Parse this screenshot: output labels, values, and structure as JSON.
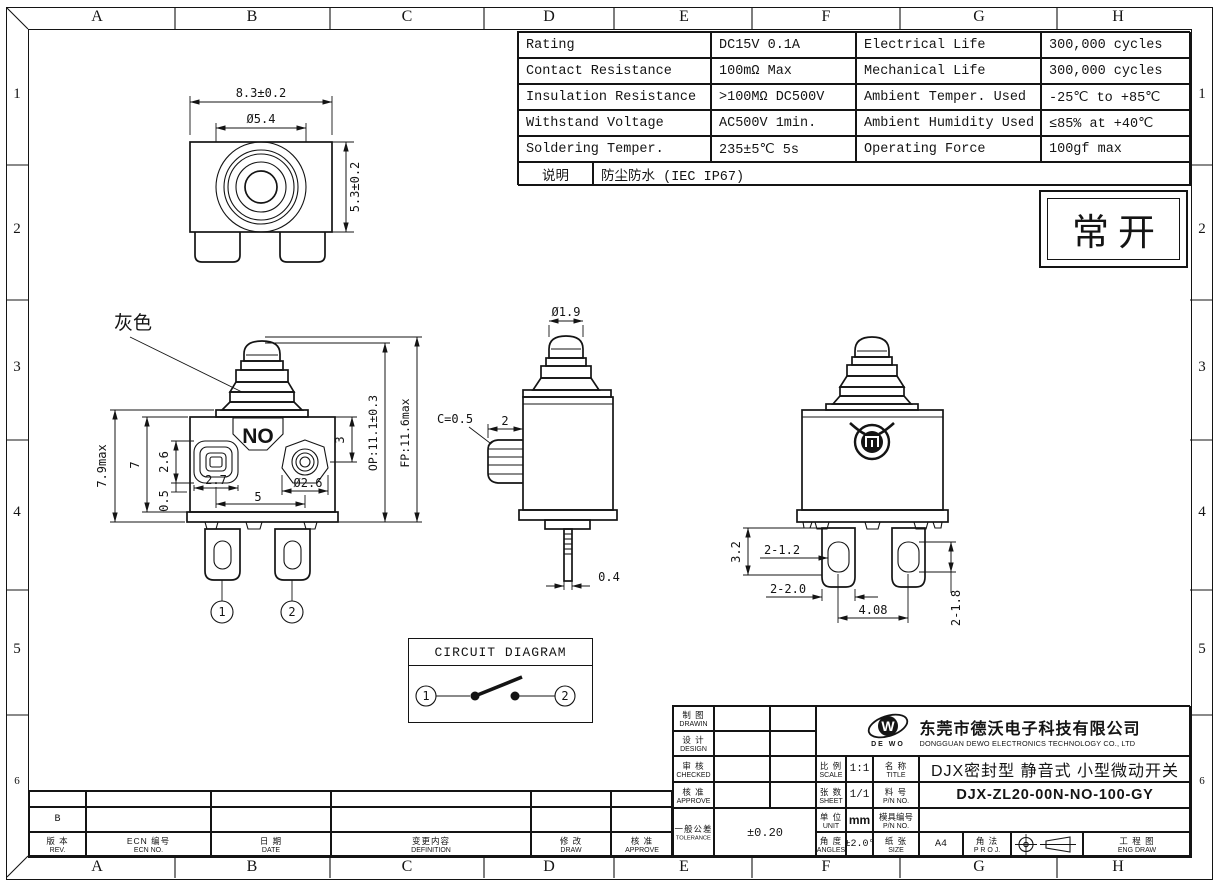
{
  "frame": {
    "cols": [
      "A",
      "B",
      "C",
      "D",
      "E",
      "F",
      "G",
      "H"
    ],
    "rows": [
      "1",
      "2",
      "3",
      "4",
      "5",
      "6"
    ]
  },
  "spec_table": {
    "rows": [
      {
        "p": "Rating",
        "pv": "DC15V 0.1A",
        "q": "Electrical Life",
        "qv": "300,000 cycles"
      },
      {
        "p": "Contact Resistance",
        "pv": "100mΩ Max",
        "q": "Mechanical Life",
        "qv": "300,000 cycles"
      },
      {
        "p": "Insulation Resistance",
        "pv": ">100MΩ DC500V",
        "q": "Ambient Temper. Used",
        "qv": "-25℃ to +85℃"
      },
      {
        "p": "Withstand Voltage",
        "pv": "AC500V  1min.",
        "q": "Ambient Humidity Used",
        "qv": "≤85% at +40℃"
      },
      {
        "p": "Soldering Temper.",
        "pv": "235±5℃ 5s",
        "q": "Operating Force",
        "qv": "100gf max"
      }
    ],
    "note_label": "说明",
    "note_value": "防尘防水 (IEC IP67)"
  },
  "state_box": {
    "text": "常开"
  },
  "views": {
    "top": {
      "dim_width": "8.3±0.2",
      "dim_circle": "Ø5.4",
      "dim_height": "5.3±0.2"
    },
    "front": {
      "gray_label": "灰色",
      "no_label": "NO",
      "dim_total_h": "7.9max",
      "dim_body_h": "7",
      "dim_term_sq": "2.6",
      "dim_base": "0.5",
      "dim_term_w": "2.7",
      "dim_pitch": "5",
      "dim_term_dia": "Ø2.6",
      "dim_depth": "3",
      "dim_op": "OP:11.1±0.3",
      "dim_fp": "FP:11.6max",
      "t1": "1",
      "t2": "2"
    },
    "side": {
      "dim_tip": "Ø1.9",
      "dim_chamfer": "C=0.5",
      "dim_boss": "2",
      "dim_pin": "0.4"
    },
    "rear": {
      "dim_h": "3.2",
      "dim_hole_w": "2-1.2",
      "dim_lug_w": "2-2.0",
      "dim_pitch": "4.08",
      "dim_hole_h": "2-1.8"
    }
  },
  "circuit": {
    "title": "CIRCUIT DIAGRAM",
    "t1": "1",
    "t2": "2"
  },
  "title_block": {
    "drawn_cn": "制 图",
    "drawn_en": "DRAWIN",
    "design_cn": "设 计",
    "design_en": "DESIGN",
    "checked_cn": "审 核",
    "checked_en": "CHECKED",
    "approve_cn": "核 准",
    "approve_en": "APPROVE",
    "tol_cn": "一般公差",
    "tol_en": "TOLERANCE",
    "tol_value": "±0.20",
    "scale_cn": "比 例",
    "scale_en": "SCALE",
    "scale_value": "1:1",
    "sheet_cn": "张 数",
    "sheet_en": "SHEET",
    "sheet_value": "1/1",
    "unit_cn": "单 位",
    "unit_en": "UNIT",
    "unit_value": "mm",
    "angles_cn": "角 度",
    "angles_en": "ANGLES",
    "angles_value": "±2.0°",
    "title_cn": "名 称",
    "title_en": "TITLE",
    "title_value": "DJX密封型 静音式 小型微动开关",
    "pn_cn": "料 号",
    "pn_en": "P/N NO.",
    "pn_value": "DJX-ZL20-00N-NO-100-GY",
    "mold_cn": "模具编号",
    "mold_en": "P/N NO.",
    "mold_value": "",
    "size_cn": "纸 张",
    "size_en": "SIZE",
    "size_value": "A4",
    "proj_cn": "角 法",
    "proj_en": "P R O J.",
    "eng_cn": "工 程 图",
    "eng_en": "ENG DRAW"
  },
  "company": {
    "logo_letter": "W",
    "logo_sub": "DE WO",
    "name_cn": "东莞市德沃电子科技有限公司",
    "name_en": "DONGGUAN DEWO ELECTRONICS TECHNOLOGY CO., LTD"
  },
  "revision": {
    "rev_value": "B",
    "headers": [
      {
        "cn": "版 本",
        "en": "REV."
      },
      {
        "cn": "ECN 编号",
        "en": "ECN NO."
      },
      {
        "cn": "日 期",
        "en": "DATE"
      },
      {
        "cn": "变更内容",
        "en": "DEFINITION"
      },
      {
        "cn": "修 改",
        "en": "DRAW"
      },
      {
        "cn": "核 准",
        "en": "APPROVE"
      }
    ]
  }
}
